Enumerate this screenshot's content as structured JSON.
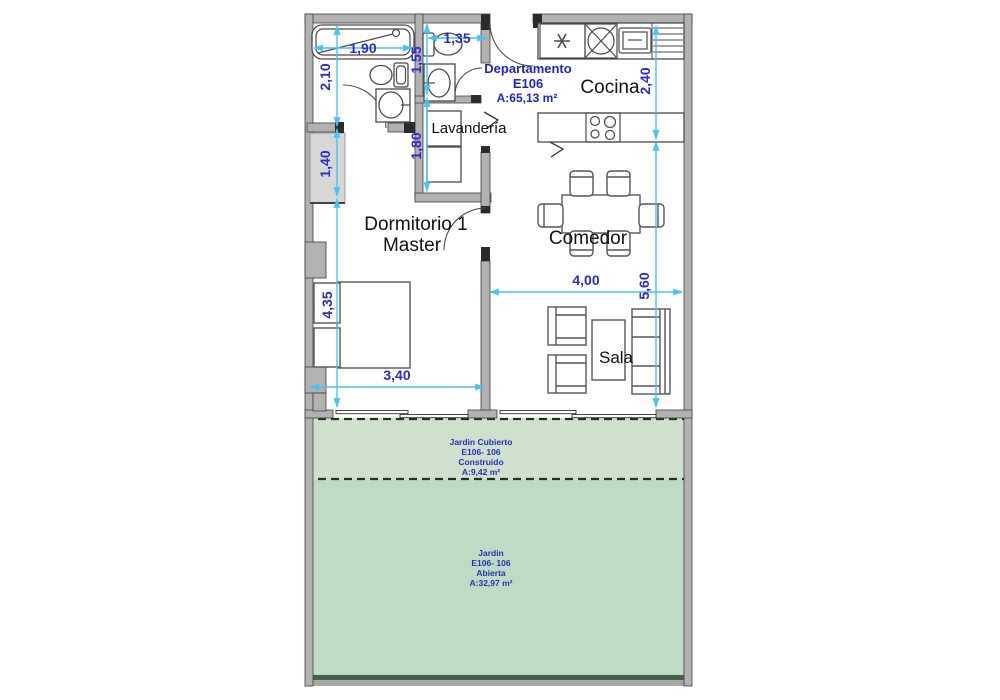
{
  "unit": {
    "name_line1": "Departamento",
    "name_line2": "E106",
    "area_label": "A:65,13 m²"
  },
  "rooms": {
    "kitchen": "Cocina",
    "laundry": "Lavandería",
    "bedroom_line1": "Dormitorio 1",
    "bedroom_line2": "Master",
    "dining": "Comedor",
    "living": "Sala"
  },
  "dims": {
    "tub_width": "1,90",
    "bath1_height": "2,10",
    "bath2_width": "1,35",
    "bath2_height": "1,55",
    "laundry_height": "1,80",
    "closet_height": "1,40",
    "bedroom_height": "4,35",
    "bedroom_width": "3,40",
    "kitchen_height": "2,40",
    "living_height": "5,60",
    "living_width": "4,00"
  },
  "covered_garden": {
    "line1": "Jardin Cubierto",
    "line2": "E106- 106",
    "line3": "Construido",
    "line4": "A:9,42 m²"
  },
  "open_garden": {
    "line1": "Jardin",
    "line2": "E106- 106",
    "line3": "Abierta",
    "line4": "A:32,97 m²"
  },
  "colors": {
    "dimension_line": "#45c4f5",
    "dimension_text": "#2a2ace",
    "unit_text": "#2222cc",
    "room_text": "#111111",
    "wall_fill": "#b2b2b2",
    "covered_garden_fill": "#cfe0cc",
    "open_garden_fill": "#bedcc3"
  }
}
